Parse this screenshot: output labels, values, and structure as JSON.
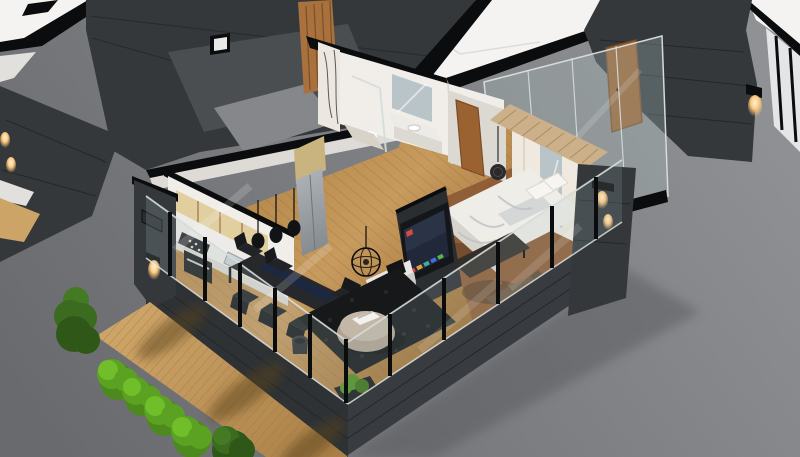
{
  "scene": {
    "type": "3d-isometric-floorplan-render",
    "view": "isometric cutaway",
    "description": "Photorealistic 3D cutaway render of a furnished one-bedroom apartment unit with a wooden terrace, set between dark-clad neighboring units on a gray ground plane",
    "rooms": [
      "kitchen",
      "dining-area",
      "living-room",
      "bathroom",
      "hallway",
      "bedroom",
      "entry-corridor",
      "terrace-deck",
      "neighboring-units"
    ],
    "objects": [
      "adjacent apartment floor plates",
      "neighboring unit dark shell",
      "wood slat feature wall",
      "marble shower column",
      "bathroom vanity with mirror",
      "toilet",
      "wooden entry doors",
      "glass entry partition",
      "kitchen with birch cabinets",
      "gas stove and oven",
      "stainless refrigerator",
      "three teardrop pendant lights",
      "black dining table with six chairs",
      "navy table runner",
      "wire globe chandelier",
      "black shag rug",
      "round beige ottoman with tray",
      "waste bin",
      "media shelf with books",
      "wall-mounted smart TV",
      "double bed with white duvet",
      "foot bench",
      "wardrobe with mirror",
      "wood slat bed canopy",
      "balcony lounge seat",
      "glass balustrades with black posts",
      "charcoal facade plinth",
      "wooden terrace deck",
      "six boxwood shrubs",
      "lit wall sconces"
    ]
  },
  "palette": {
    "bg_top": "#909194",
    "bg_bottom": "#696a6d",
    "plate": "#f4f3f1",
    "plate_shade": "#e1e0dd",
    "cut": "#0b0c0d",
    "wall": "#34383b",
    "wall_deep": "#2b2e31",
    "wall_seam": "#24272a",
    "nfloor": "#4b4e51",
    "nfloor_light": "#85878a",
    "plinth": "#2e3235",
    "plinth_r": "#383c40",
    "glass": "#a8bcbe",
    "glass_frame": "#d5dbdb",
    "white_line": "#e8e8e6",
    "floor_a": "#c79a5e",
    "floor_b": "#a97c3f",
    "plank": "#8f6530",
    "bedroom_floor": "#8d5c36",
    "deck_a": "#cda468",
    "deck_b": "#aa8047",
    "deck_line": "#9c7439",
    "deck_shadow": "#5a431f",
    "int_wall": "#f1eeea",
    "int_wall_shade": "#dcd8d2",
    "marble": "#ece7e0",
    "marble_vein": "#35373a",
    "slat": "#a8713d",
    "slat_line": "#7d4f26",
    "birch": "#e2cfa0",
    "birch_side": "#c9b37e",
    "counter": "#edebe7",
    "steel_a": "#aab0b4",
    "steel_b": "#7e8488",
    "appliance": "#232527",
    "black": "#121314",
    "table": "#26282b",
    "runner": "#1c2742",
    "chair": "#212326",
    "chair_dark": "#17191c",
    "rug": "#17181a",
    "rug_dot": "#27292c",
    "pouf": "#b0a190",
    "pouf_top": "#c4b7a7",
    "tray": "#f2f1ee",
    "shelf": "#e9e7e3",
    "tv": "#141619",
    "tv_screen": "#20283a",
    "app_red": "#d84b3f",
    "app_orange": "#e0a03c",
    "app_teal": "#3fae9f",
    "app_blue": "#3f6fd8",
    "app_green": "#58b54a",
    "duvet": "#efede8",
    "duvet_fold": "#bfc2c6",
    "mattress": "#d8d5cf",
    "bench": "#332e2a",
    "wardrobe": "#efe9df",
    "mirror": "#b9c4c8",
    "canopy": "#cbb089",
    "canopy_line": "#a98e63",
    "door": "#9a6231",
    "door_dark": "#7c4c26",
    "sofa": "#705a44",
    "sofa_line": "#5a4836",
    "plant": "#4f8f22",
    "plant_dark": "#3b6f17",
    "planter": "#17191b",
    "bush_light": "#6fbe2a",
    "bush_mid": "#5ba122",
    "bush_base": "#4c8a1d",
    "bush2_light": "#447a24",
    "bush2_mid": "#3a6b1f",
    "bush2_base": "#2f5718",
    "shadow": "#55565a",
    "glow": "#ffc97e",
    "glow_core": "#fff3dc"
  }
}
